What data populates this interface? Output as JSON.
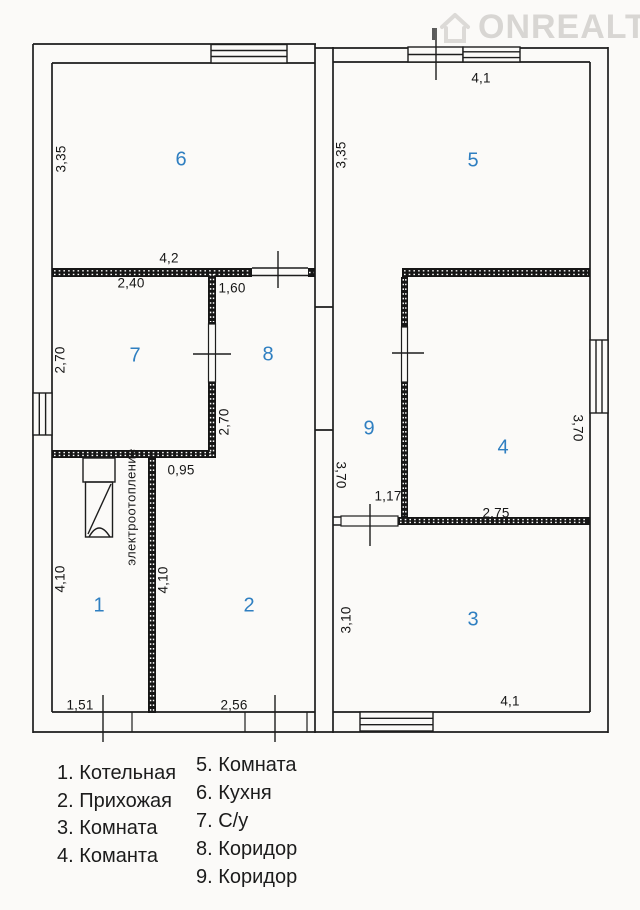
{
  "watermark": {
    "brand": "ONREALT"
  },
  "colors": {
    "accent_blue": "#2f7fc1",
    "wall": "#1d1d1d",
    "watermark_gray": "#d8d6d3"
  },
  "plan": {
    "rooms": {
      "r1": "1",
      "r2": "2",
      "r3": "3",
      "r4": "4",
      "r5": "5",
      "r6": "6",
      "r7": "7",
      "r8": "8",
      "r9": "9"
    },
    "dims": {
      "k6_left": "3,35",
      "w78_top": "4,2",
      "r7_top": "2,40",
      "r8_top": "1,60",
      "r7_left": "2,70",
      "r7_right": "2,70",
      "r2_top": "0,95",
      "r1_left": "4,10",
      "r2_left": "4,10",
      "r1_bottom": "1,51",
      "r2_bottom": "2,56",
      "r5_left": "3,35",
      "r5_top": "4,1",
      "r9_left": "3,70",
      "r9_bottom": "1,17",
      "r4_bottom": "2,75",
      "r4_right": "3,70",
      "r3_left": "3,10",
      "r3_bottom": "4,1",
      "heating": "электроотопление"
    }
  },
  "legend": {
    "col1": [
      "1. Котельная",
      "2. Прихожая",
      "3. Комната",
      "4. Команта"
    ],
    "col2": [
      "5. Комната",
      "6. Кухня",
      "7. С/у",
      "8. Коридор",
      "9. Коридор"
    ]
  }
}
